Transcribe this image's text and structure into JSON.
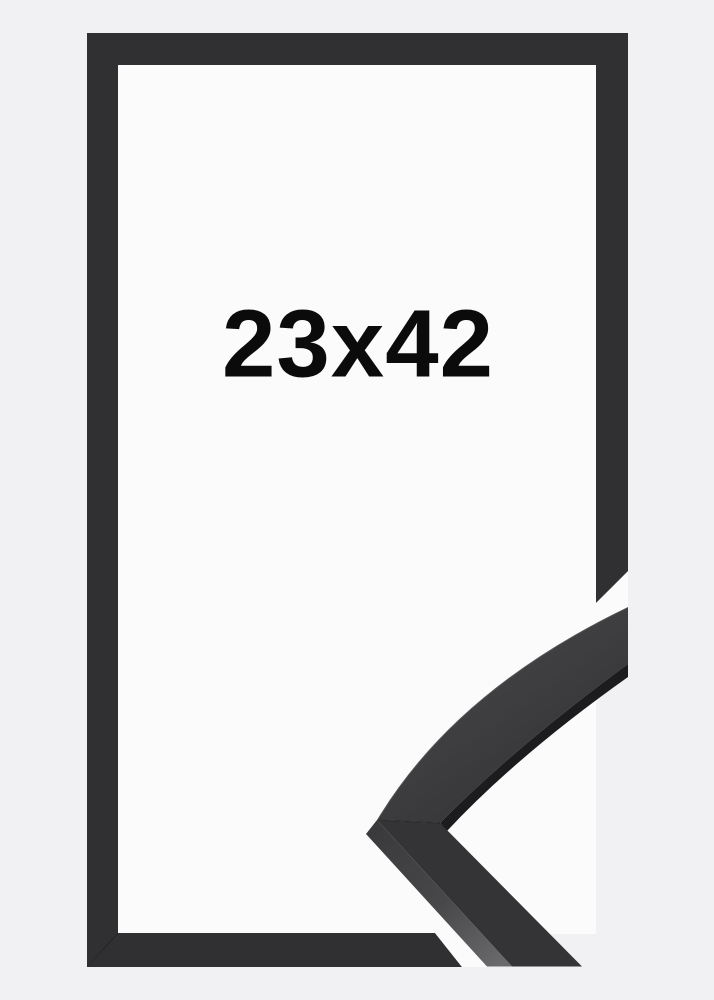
{
  "product": {
    "size_label": "23x42"
  },
  "colors": {
    "background": "#f1f1f3",
    "frame_interior": "#fbfbfb",
    "frame_bar": "#303032",
    "gap_white": "#fbfbfb",
    "moulding_top_upper": "#3b3b3d",
    "moulding_top_lower": "#343436",
    "moulding_edge_band": "#1c1c1e",
    "moulding_side_dark": "#39393b",
    "moulding_side_light": "#6a6a6c",
    "label_text": "#0b0b0b"
  }
}
